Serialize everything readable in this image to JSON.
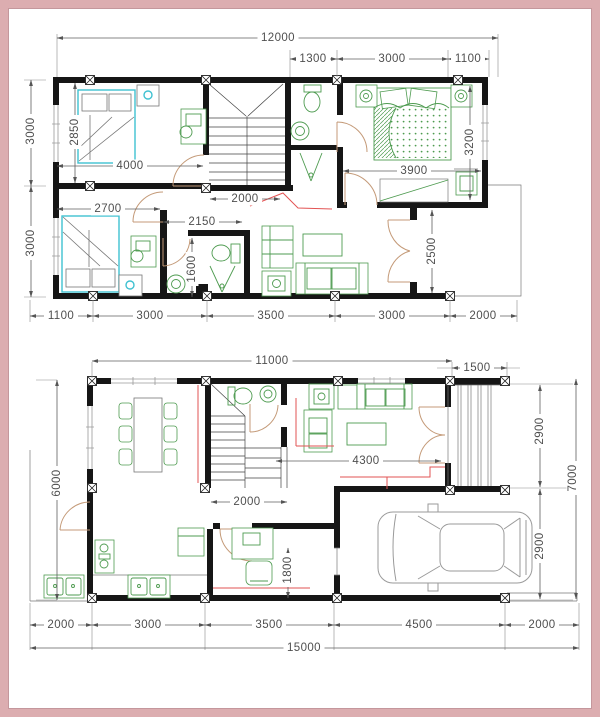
{
  "drawing": {
    "type": "house-floor-plans",
    "sheets": [
      "first-floor-plan",
      "ground-floor-plan"
    ]
  },
  "colors": {
    "frame_pink": "#dcadb0",
    "wall_black": "#161616",
    "furniture_green": "#4e9b50",
    "bed_cyan": "#3fc1d1",
    "door_tan": "#c49a78",
    "accent_red": "#e25353",
    "dimension_gray": "#4f4f4f",
    "car_gray": "#9a9a9a"
  },
  "icons": [
    "bed-icon",
    "toilet-icon",
    "sink-icon",
    "shower-icon",
    "sofa-icon",
    "coffee-table-icon",
    "dining-table-icon",
    "chair-icon",
    "stairs-icon",
    "car-icon",
    "stove-icon",
    "fridge-icon",
    "kitchen-sink-icon",
    "wardrobe-icon",
    "desk-icon",
    "door-swing-icon",
    "window-icon",
    "column-marker-icon",
    "nightstand-icon",
    "plant-table-icon"
  ],
  "floors": {
    "first": {
      "name": "first-floor-plan",
      "dims": [
        {
          "t": "12000",
          "x": 278,
          "y": 38,
          "o": "h"
        },
        {
          "t": "1300",
          "x": 313,
          "y": 59,
          "o": "h"
        },
        {
          "t": "3000",
          "x": 392,
          "y": 59,
          "o": "h"
        },
        {
          "t": "1100",
          "x": 468,
          "y": 59,
          "o": "h"
        },
        {
          "t": "3000",
          "x": 31,
          "y": 131,
          "o": "v"
        },
        {
          "t": "3000",
          "x": 31,
          "y": 243,
          "o": "v"
        },
        {
          "t": "2850",
          "x": 75,
          "y": 132,
          "o": "v"
        },
        {
          "t": "4000",
          "x": 130,
          "y": 166,
          "o": "h"
        },
        {
          "t": "2700",
          "x": 108,
          "y": 209,
          "o": "h"
        },
        {
          "t": "2150",
          "x": 202,
          "y": 222,
          "o": "h"
        },
        {
          "t": "1600",
          "x": 192,
          "y": 269,
          "o": "v"
        },
        {
          "t": "2000",
          "x": 245,
          "y": 199,
          "o": "h"
        },
        {
          "t": "3900",
          "x": 414,
          "y": 171,
          "o": "h"
        },
        {
          "t": "3200",
          "x": 470,
          "y": 142,
          "o": "v"
        },
        {
          "t": "2500",
          "x": 432,
          "y": 251,
          "o": "v"
        },
        {
          "t": "1100",
          "x": 61,
          "y": 316,
          "o": "h"
        },
        {
          "t": "3000",
          "x": 150,
          "y": 316,
          "o": "h"
        },
        {
          "t": "3500",
          "x": 271,
          "y": 316,
          "o": "h"
        },
        {
          "t": "3000",
          "x": 392,
          "y": 316,
          "o": "h"
        },
        {
          "t": "2000",
          "x": 483,
          "y": 316,
          "o": "h"
        }
      ]
    },
    "ground": {
      "name": "ground-floor-plan",
      "dims": [
        {
          "t": "11000",
          "x": 272,
          "y": 361,
          "o": "h"
        },
        {
          "t": "1500",
          "x": 477,
          "y": 368,
          "o": "h"
        },
        {
          "t": "6000",
          "x": 57,
          "y": 483,
          "o": "v"
        },
        {
          "t": "2900",
          "x": 540,
          "y": 431,
          "o": "v"
        },
        {
          "t": "2900",
          "x": 540,
          "y": 546,
          "o": "v"
        },
        {
          "t": "7000",
          "x": 573,
          "y": 478,
          "o": "v"
        },
        {
          "t": "4300",
          "x": 366,
          "y": 461,
          "o": "h"
        },
        {
          "t": "2000",
          "x": 247,
          "y": 502,
          "o": "h"
        },
        {
          "t": "1800",
          "x": 288,
          "y": 570,
          "o": "v"
        },
        {
          "t": "2000",
          "x": 61,
          "y": 625,
          "o": "h"
        },
        {
          "t": "3000",
          "x": 148,
          "y": 625,
          "o": "h"
        },
        {
          "t": "3500",
          "x": 269,
          "y": 625,
          "o": "h"
        },
        {
          "t": "4500",
          "x": 419,
          "y": 625,
          "o": "h"
        },
        {
          "t": "2000",
          "x": 542,
          "y": 625,
          "o": "h"
        },
        {
          "t": "15000",
          "x": 304,
          "y": 648,
          "o": "h"
        }
      ]
    }
  }
}
